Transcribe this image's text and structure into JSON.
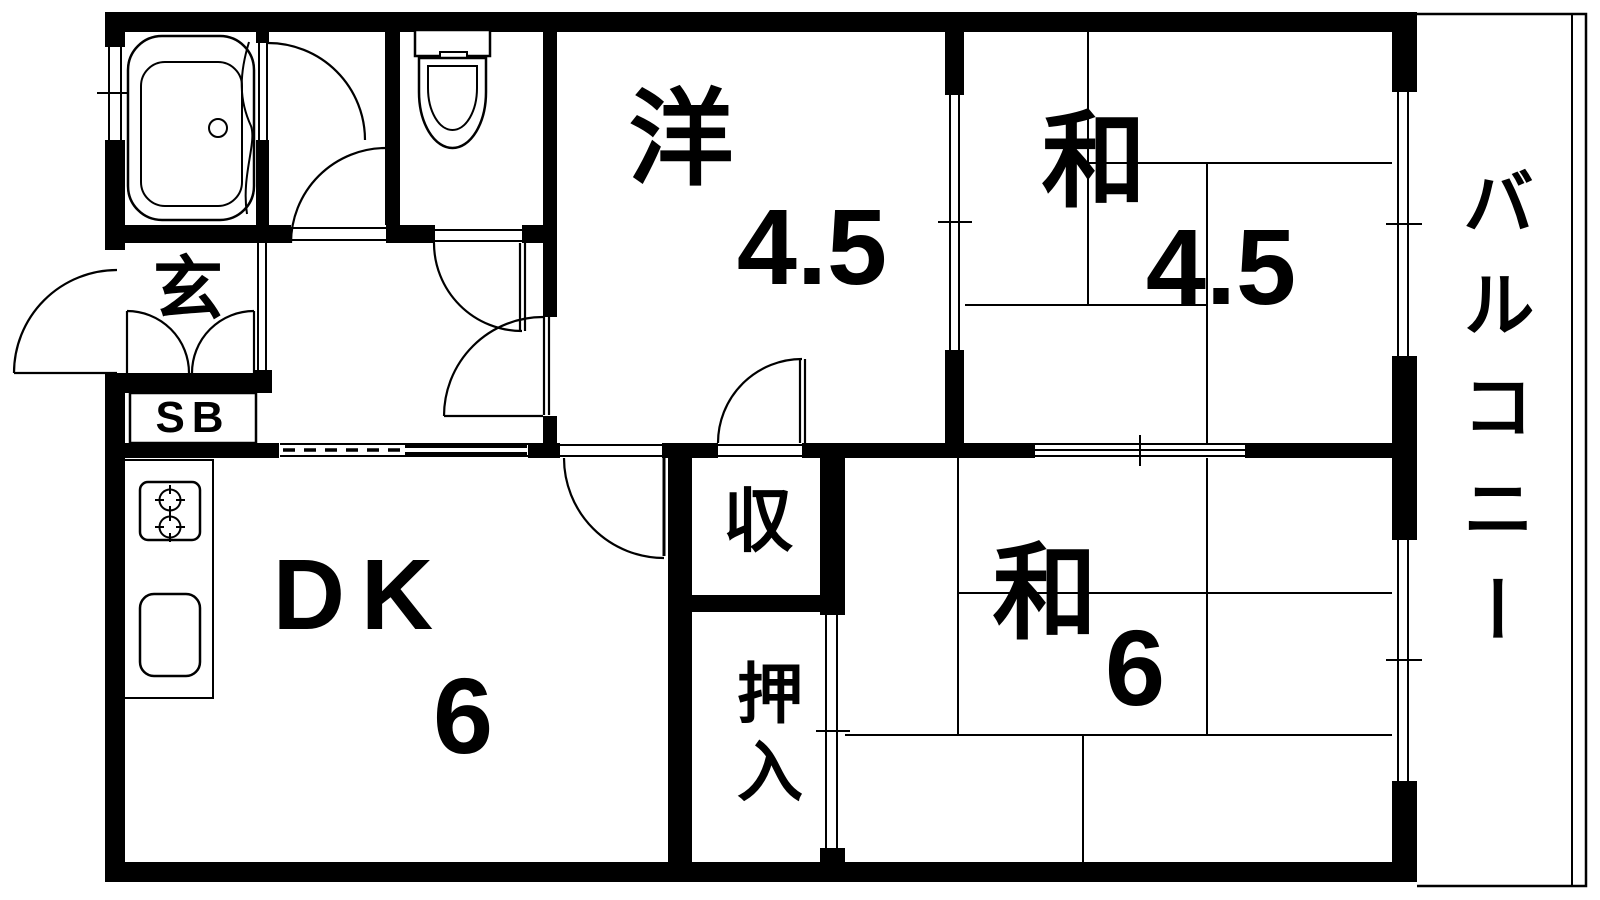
{
  "title": "apartment-floor-plan",
  "colors": {
    "wall": "#000000",
    "background": "#ffffff",
    "line": "#000000"
  },
  "rooms": {
    "western": {
      "label": "洋",
      "size": "4.5"
    },
    "japanese_upper": {
      "label": "和",
      "size": "4.5"
    },
    "japanese_lower": {
      "label": "和",
      "size": "6"
    },
    "dining_kitchen": {
      "label": "DK",
      "size": "6"
    },
    "entrance": {
      "label": "玄"
    },
    "shoe_box": {
      "label": "SB"
    },
    "storage": {
      "label": "収"
    },
    "closet": {
      "label": "押入"
    },
    "balcony": {
      "label": "バルコニー"
    }
  },
  "fixtures": {
    "bathtub": "bathtub-icon",
    "toilet": "toilet-icon",
    "stove": "stove-burners-icon",
    "sink": "kitchen-sink-icon"
  }
}
